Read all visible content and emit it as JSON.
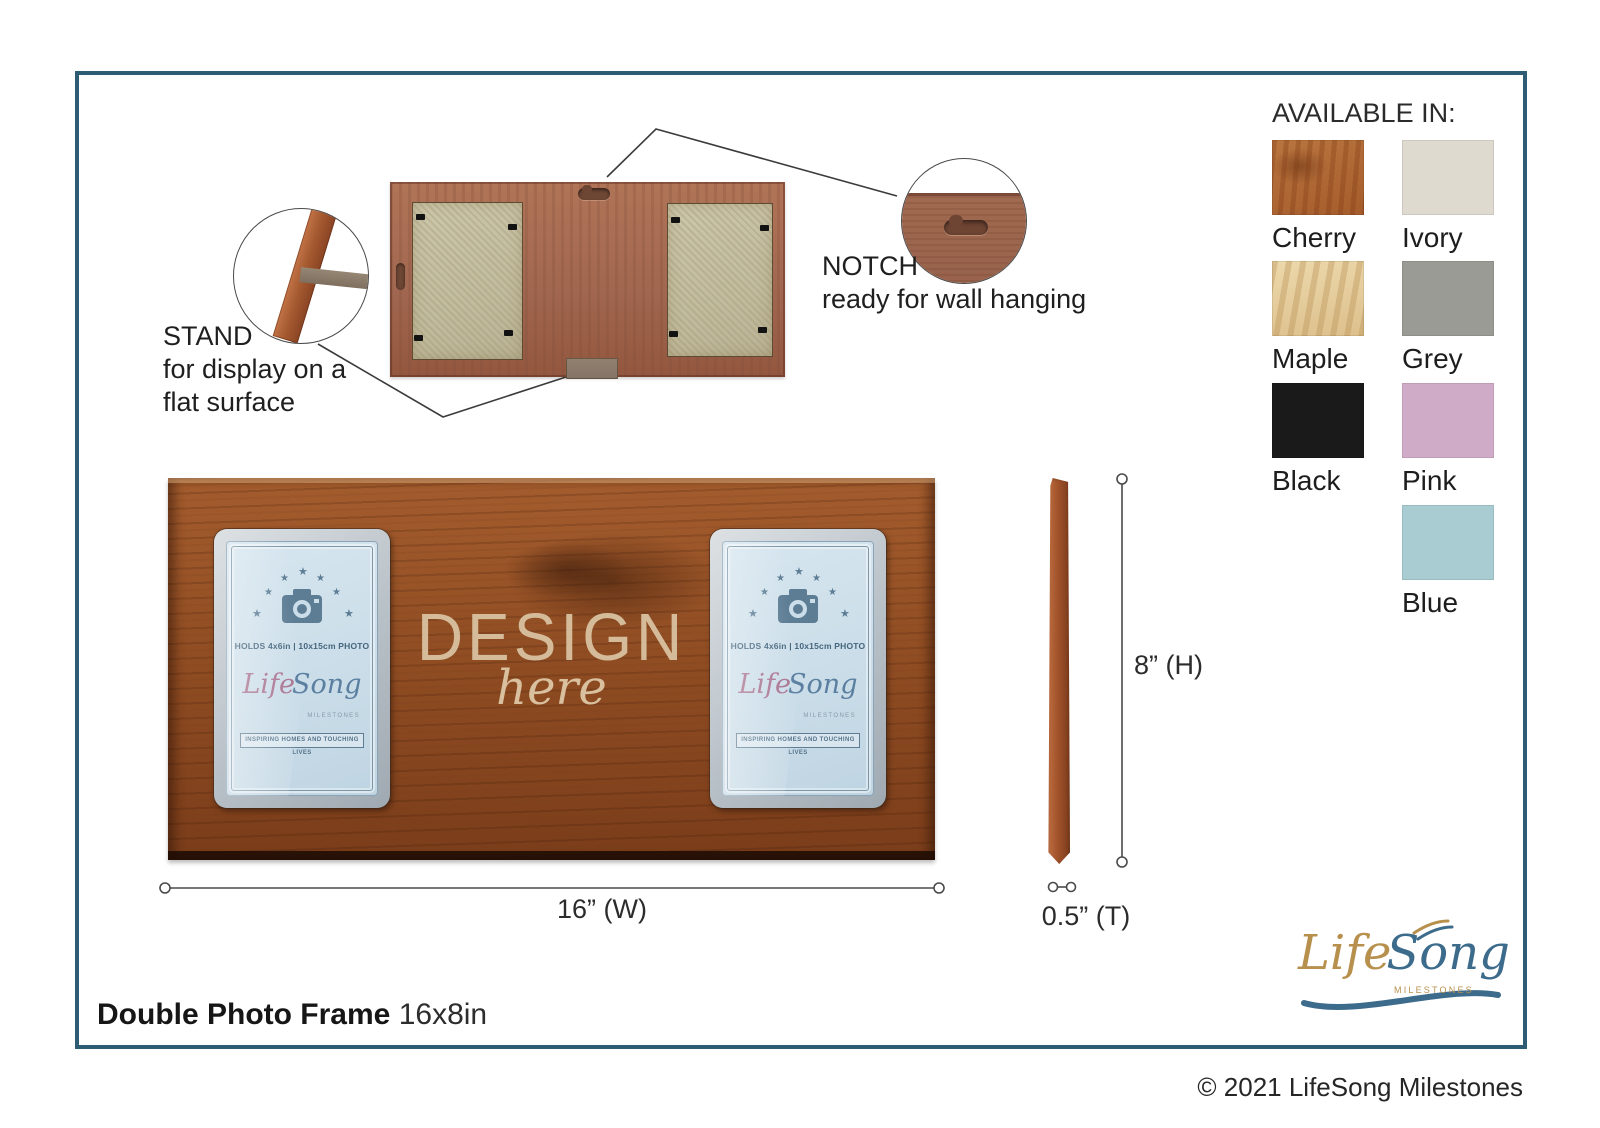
{
  "page": {
    "title_bold": "Double Photo Frame",
    "title_size": "16x8in",
    "copyright": "© 2021 LifeSong Milestones"
  },
  "annotations": {
    "stand": {
      "title": "STAND",
      "line1": "for display on a",
      "line2": "flat surface"
    },
    "notch": {
      "title": "NOTCH",
      "subtitle": "ready for wall hanging"
    }
  },
  "dimensions": {
    "width": "16” (W)",
    "height": "8” (H)",
    "thickness": "0.5” (T)"
  },
  "available": {
    "heading": "AVAILABLE IN:",
    "options": [
      {
        "name": "Cherry",
        "color": "#a55c2c",
        "wood": true
      },
      {
        "name": "Ivory",
        "color": "#dedad0",
        "wood": false
      },
      {
        "name": "Maple",
        "color": "#e3cb9b",
        "wood": true
      },
      {
        "name": "Grey",
        "color": "#9b9b95",
        "wood": false
      },
      {
        "name": "Black",
        "color": "#1a1a1a",
        "wood": false
      },
      {
        "name": "Pink",
        "color": "#d0abc7",
        "wood": false
      },
      {
        "name": "Blue",
        "color": "#a9ccd2",
        "wood": false
      }
    ]
  },
  "insert": {
    "holds": "HOLDS 4x6in | 10x15cm PHOTO",
    "life": "Life",
    "song": "Song",
    "milestones": "MILESTONES",
    "banner": "INSPIRING HOMES AND TOUCHING LIVES"
  },
  "design": {
    "line1": "DESIGN",
    "line2": "here"
  },
  "logo": {
    "life": "Life",
    "song": "Song",
    "milestones": "MILESTONES"
  }
}
